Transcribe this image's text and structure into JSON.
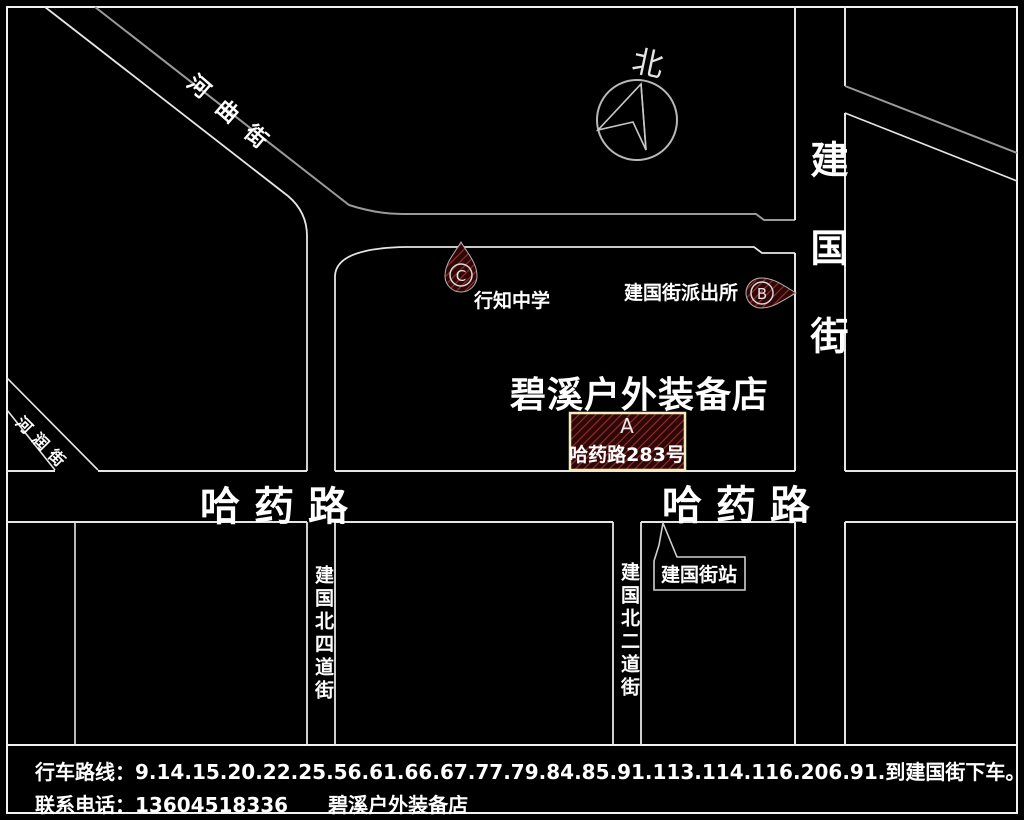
{
  "map": {
    "compass": {
      "label": "北"
    },
    "streets": {
      "hequ": "河曲街",
      "herun": "河润街",
      "jianguo": "建国街",
      "hayao": "哈药路",
      "jianguo_n4": "建国北四道街",
      "jianguo_n2": "建国北二道街"
    },
    "pois": {
      "school": {
        "marker_letter": "C",
        "name": "行知中学"
      },
      "police": {
        "marker_letter": "B",
        "name": "建国街派出所"
      },
      "store": {
        "marker_letter": "A",
        "name": "碧溪户外装备店",
        "address": "哈药路283号"
      },
      "bus_stop": {
        "name": "建国街站"
      }
    },
    "colors": {
      "background": "#000000",
      "road_line_bright": "#e6e6e6",
      "road_line_dim": "#9a9a9a",
      "marker_fill": "#300707",
      "marker_hatch": "#933030",
      "address_box_border": "#f2ecc0",
      "text": "#ffffff"
    }
  },
  "footer": {
    "route": "行车路线：9.14.15.20.22.25.56.61.66.67.77.79.84.85.91.113.114.116.206.91.到建国街下车。哈药路283号。",
    "contact": "联系电话：13604518336　　碧溪户外装备店"
  }
}
